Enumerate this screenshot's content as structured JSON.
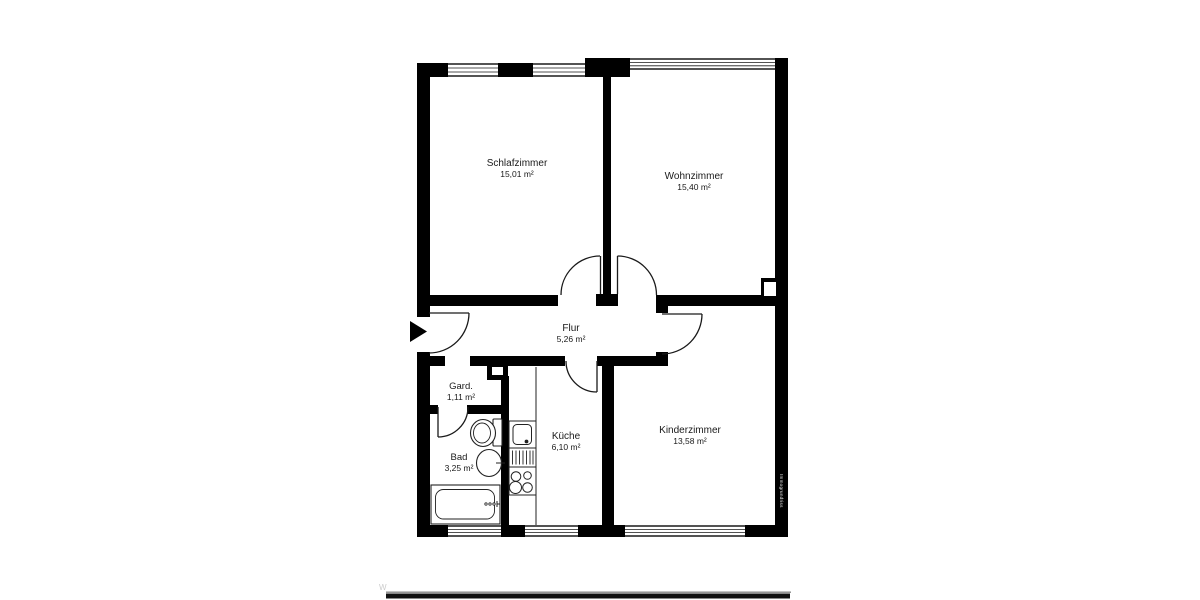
{
  "floorplan": {
    "rooms": [
      {
        "id": "schlafzimmer",
        "name": "Schlafzimmer",
        "area": "15,01 m²"
      },
      {
        "id": "wohnzimmer",
        "name": "Wohnzimmer",
        "area": "15,40 m²"
      },
      {
        "id": "flur",
        "name": "Flur",
        "area": "5,26 m²"
      },
      {
        "id": "gard",
        "name": "Gard.",
        "area": "1,11 m²"
      },
      {
        "id": "bad",
        "name": "Bad",
        "area": "3,25 m²"
      },
      {
        "id": "kueche",
        "name": "Küche",
        "area": "6,10 m²"
      },
      {
        "id": "kinderzimmer",
        "name": "Kinderzimmer",
        "area": "13,58 m²"
      }
    ],
    "watermark": "Immogrundriss",
    "corner_mark": "W",
    "colors": {
      "wall": "#000000",
      "background": "#ffffff",
      "line": "#1a1a1a"
    }
  }
}
